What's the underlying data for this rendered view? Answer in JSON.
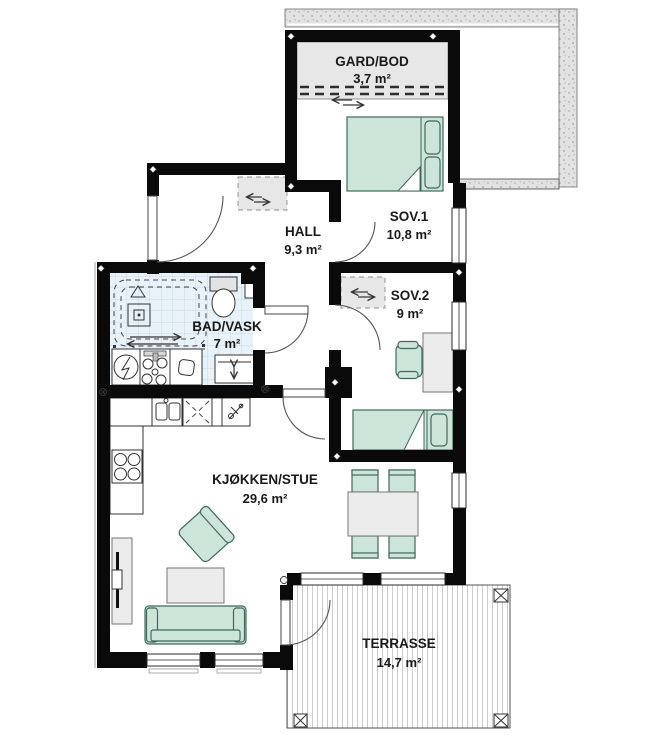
{
  "floorplan": {
    "rooms": [
      {
        "name": "GARD/BOD",
        "area": "3,7 m²"
      },
      {
        "name": "SOV.1",
        "area": "10,8 m²"
      },
      {
        "name": "HALL",
        "area": "9,3 m²"
      },
      {
        "name": "SOV.2",
        "area": "9 m²"
      },
      {
        "name": "BAD/VASK",
        "area": "7 m²"
      },
      {
        "name": "KJØKKEN/STUE",
        "area": "29,6 m²"
      },
      {
        "name": "TERRASSE",
        "area": "14,7 m²"
      }
    ],
    "colors": {
      "wall": "#0a0a0a",
      "furniture_green": "#cde5d9",
      "furniture_green_stroke": "#41685c",
      "gray_fill": "#e7e7e7",
      "tile_bg": "#eaf2f9",
      "text": "#1a1a1a"
    },
    "fixtures": [
      "double-bed",
      "single-bed",
      "sliding-wardrobe",
      "desk",
      "desk-chair",
      "dining-table",
      "dining-chair",
      "sofa",
      "armchair",
      "coffee-table",
      "tv-bench",
      "kitchen-counter",
      "cooktop",
      "kitchen-sink",
      "dishwasher",
      "washing-machine",
      "dryer",
      "laundry-sink",
      "shower",
      "toilet",
      "bathroom-vanity",
      "deck-post"
    ]
  }
}
